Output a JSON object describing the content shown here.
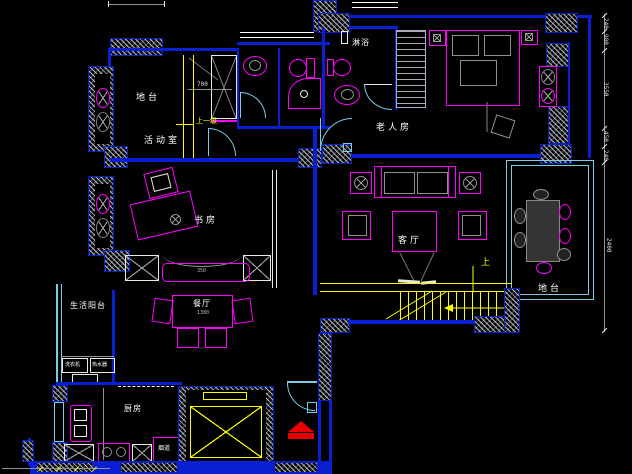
{
  "drawing": {
    "type": "floor-plan-cad",
    "colors": {
      "background": "#000000",
      "wall": "#0a1ed2",
      "furniture": "#ff00ff",
      "door": "#7ecbe8",
      "stairs": "#ffff00",
      "text": "#ffffff",
      "entry_arrow": "#ff0000",
      "detail": "#909090"
    },
    "rooms": {
      "platform_nw": {
        "label": "地台"
      },
      "activity": {
        "label": "活动室"
      },
      "study": {
        "label": "书房"
      },
      "shower_room": {
        "label": "淋浴"
      },
      "elder_room": {
        "label": "老人房"
      },
      "living": {
        "label": "客厅"
      },
      "dining": {
        "label": "餐厅"
      },
      "service_balcony": {
        "label": "生活阳台"
      },
      "kitchen": {
        "label": "厨房"
      },
      "platform_e": {
        "label": "地台"
      }
    },
    "annotations": {
      "stair_up": "上",
      "step_up": "上一级",
      "flue": "烟道",
      "washer": "洗衣机",
      "water_heater": "热水器",
      "dim_700": "700",
      "dim_1380": "1380",
      "dim_350": "350"
    },
    "dims_right": [
      "240",
      "980",
      "3550",
      "450",
      "240",
      "2400"
    ]
  }
}
